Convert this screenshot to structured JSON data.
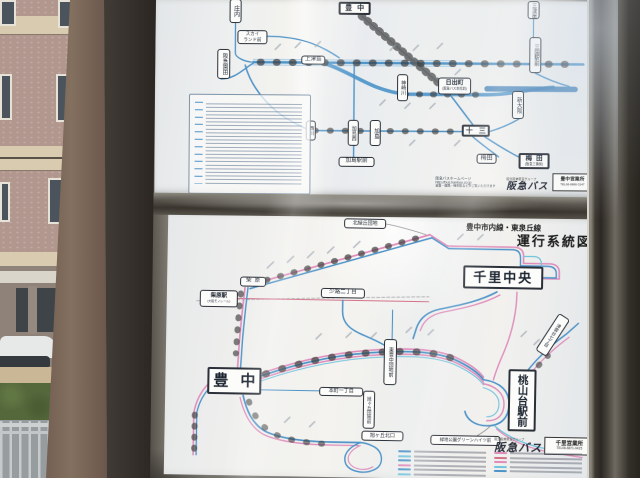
{
  "photo": {
    "scene": "bus stop route-map display case beside an apartment building",
    "route_colors": {
      "blue": "#4e93c8",
      "pink": "#df8cba",
      "cyan": "#72c3de",
      "red": "#d4728a"
    }
  },
  "top_map": {
    "stations": {
      "toyonaka": "豊中",
      "shonai": "庄内",
      "sonoda": "阪急園田",
      "skyland_line1": "スカイ",
      "skyland_line2": "ランド前",
      "kamitsushima": "上津島",
      "kanzakigawa": "神崎川",
      "hinodecho": "日出町",
      "hinodecho_sub": "(阪急バス本社前)",
      "juso": "十三",
      "umeda_a": "梅田",
      "umeda_b": "梅田",
      "umeda_b_sub": "(阪急三番街)",
      "nishikawa": "西川",
      "kashima_nishi": "加島西",
      "kashima": "加島",
      "kashima_ekimae": "加島駅前",
      "mikuni_ekimae": "三国駅前",
      "shin_osaka": "新大阪",
      "mitsuya": "三津屋"
    },
    "footer": {
      "homepage_label": "阪急バスホームページ",
      "homepage_url": "http://bus.hankyu.co.jp",
      "homepage_note": "運賃・経路・時刻表などがご覧いただけます",
      "brand_group": "阪急阪神東宝グループ",
      "brand_logo": "阪急バス",
      "office_name": "豊中営業所",
      "office_phone": "TEL06-6866-3147"
    }
  },
  "bottom_map": {
    "title_line1": "豊中市内線・東泉丘線",
    "title_line2": "運行系統図",
    "stations": {
      "kita_midorigaoka": "北緑丘団地",
      "senri_chuo": "千里中央",
      "shibahara": "柴原",
      "shibahara_eki": "柴原駅",
      "shibahara_eki_sub": "(大阪モノレール)",
      "shoji": "少路二丁目",
      "toyonaka": "豊中",
      "honmachi": "本町一丁目",
      "higashi_toyonaka": "東豊中団地前",
      "asahigaoka_danchi": "旭ヶ丘団地前",
      "asahigaoka_kitaguchi": "旭ヶ丘北口",
      "momoyamadai": "桃山台駅前",
      "tsukumodai": "津雲台七丁目",
      "ryokuchi_koen": "緑地公園グリーンハイツ前"
    },
    "footer": {
      "brand_group": "阪急阪神東宝グループ",
      "brand_logo": "阪急バス",
      "office_name": "千里営業所",
      "office_phone": "TEL06-6871-0415"
    }
  }
}
